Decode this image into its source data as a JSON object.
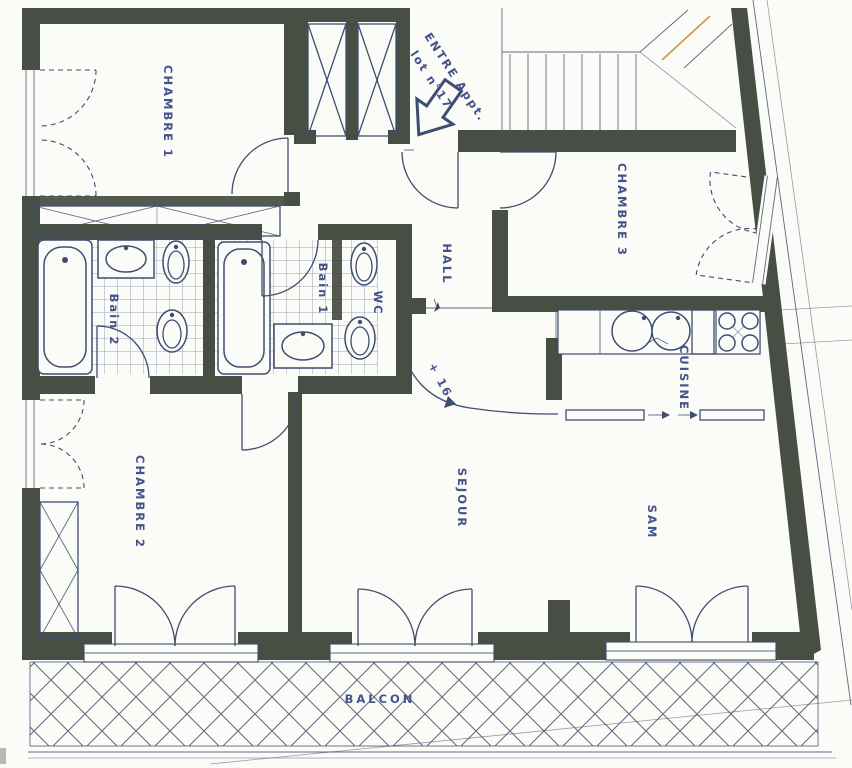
{
  "meta": {
    "type": "architectural-floor-plan",
    "description": "Scanned apartment floor plan, lot n°17"
  },
  "labels": {
    "chambre1": "CHAMBRE 1",
    "chambre2": "CHAMBRE 2",
    "chambre3": "CHAMBRE 3",
    "hall": "HALL",
    "sejour": "SEJOUR",
    "sam": "SAM",
    "cuisine": "CUISINE",
    "bain1": "Bain 1",
    "bain2": "Bain 2",
    "wc": "WC",
    "balcon": "BALCON",
    "entry_line1": "ENTRE Appt.",
    "entry_line2": "lot n°17",
    "level_mark": "+ 16"
  },
  "colors": {
    "paper": "#fbfbf8",
    "wall": "#474e43",
    "ink": "#3f4d70",
    "tile": "#7e89a8",
    "lattice": "#5e6880",
    "label": "#46538a",
    "orange": "#c89a45"
  }
}
